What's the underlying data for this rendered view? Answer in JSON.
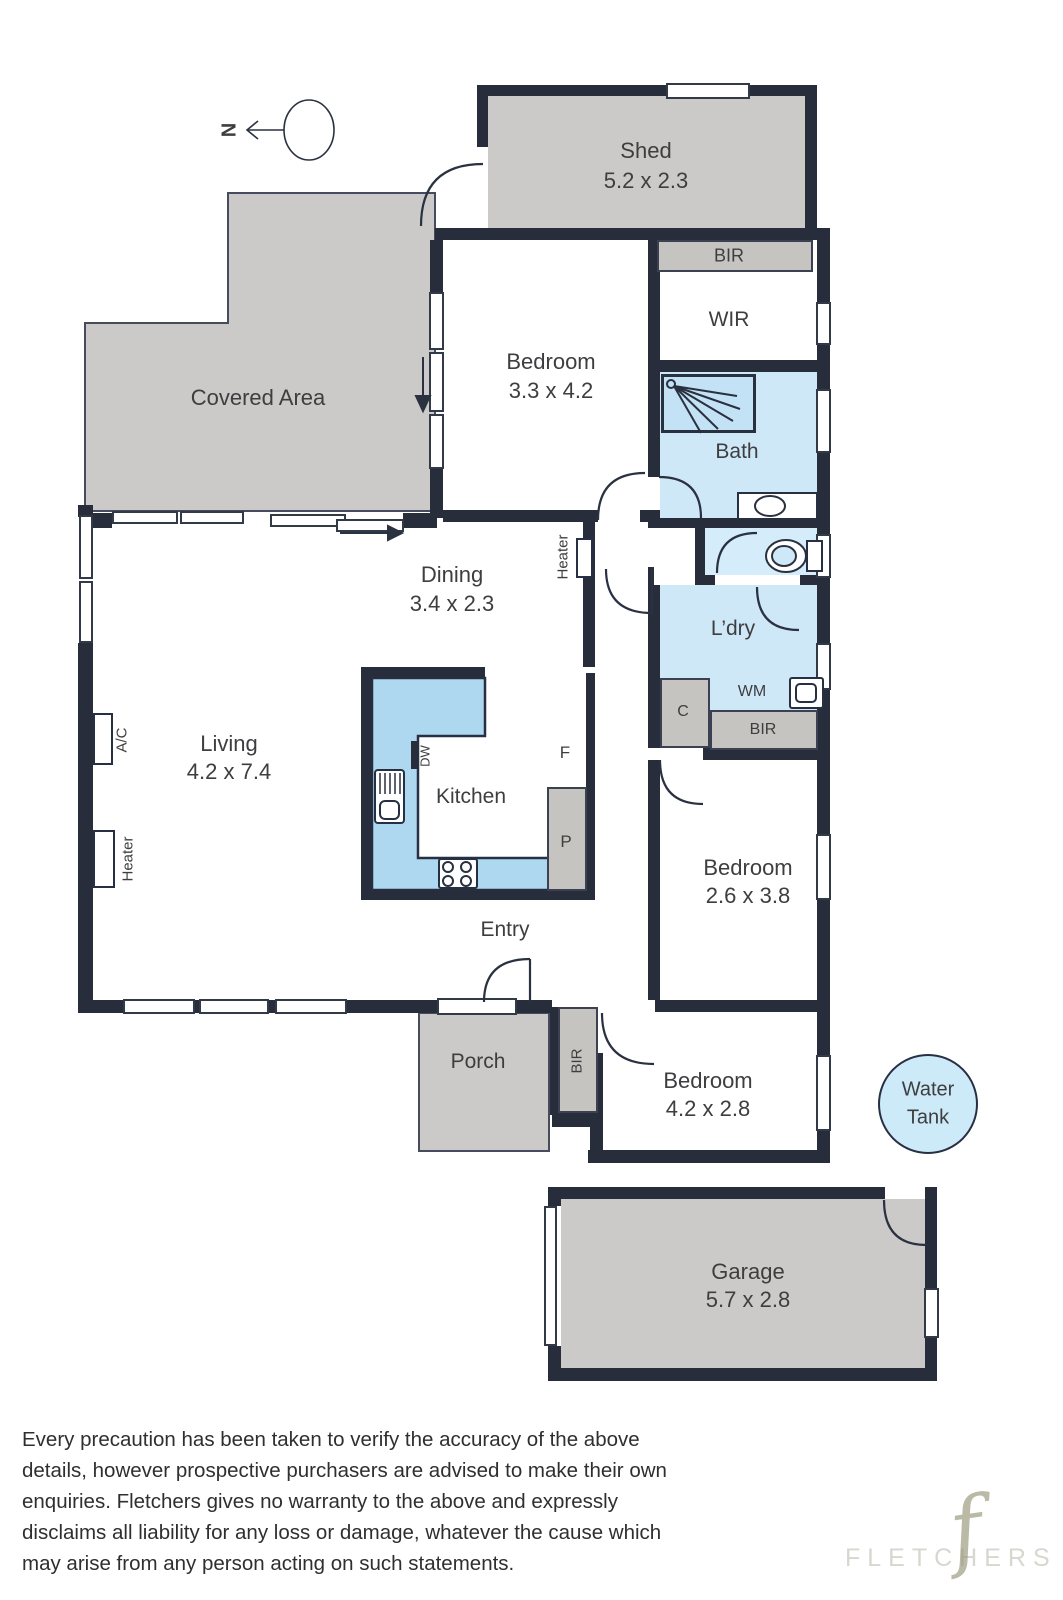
{
  "north_label": "N",
  "rooms": {
    "shed": {
      "name": "Shed",
      "dims": "5.2 x 2.3"
    },
    "covered": {
      "name": "Covered Area"
    },
    "bedroom1": {
      "name": "Bedroom",
      "dims": "3.3 x 4.2"
    },
    "wir": {
      "name": "WIR"
    },
    "bir_top": {
      "name": "BIR"
    },
    "bath": {
      "name": "Bath"
    },
    "dining": {
      "name": "Dining",
      "dims": "3.4 x 2.3"
    },
    "heater_hall": {
      "name": "Heater"
    },
    "ldry": {
      "name": "L’dry"
    },
    "wm": {
      "name": "WM"
    },
    "closet": {
      "name": "C"
    },
    "bir_mid": {
      "name": "BIR"
    },
    "living": {
      "name": "Living",
      "dims": "4.2 x 7.4"
    },
    "ac": {
      "name": "A/C"
    },
    "heater_left": {
      "name": "Heater"
    },
    "kitchen": {
      "name": "Kitchen"
    },
    "dw": {
      "name": "DW"
    },
    "fridge": {
      "name": "F"
    },
    "pantry": {
      "name": "P"
    },
    "entry": {
      "name": "Entry"
    },
    "porch": {
      "name": "Porch"
    },
    "bir_entry": {
      "name": "BIR"
    },
    "bedroom2": {
      "name": "Bedroom",
      "dims": "2.6 x 3.8"
    },
    "bedroom3": {
      "name": "Bedroom",
      "dims": "4.2 x 2.8"
    },
    "water_tank": {
      "line1": "Water",
      "line2": "Tank"
    },
    "garage": {
      "name": "Garage",
      "dims": "5.7 x 2.8"
    }
  },
  "disclaimer": {
    "lines": [
      "Every precaution has been taken to verify the accuracy of the above",
      "details, however prospective purchasers are advised to make their own",
      "enquiries. Fletchers gives no warranty to the above and expressly",
      "disclaims all liability for any loss or damage, whatever the cause which",
      "may arise from any person acting on such statements."
    ]
  },
  "watermark": {
    "brand": "FLETCHERS",
    "glyph": "f"
  },
  "colors": {
    "wall": "#272d3b",
    "outdoor_gray": "#cbcac8",
    "closet_gray": "#c6c4c0",
    "wet_area_blue": "#cfe8f8",
    "kitchen_blue": "#aed8ef",
    "water_tank_blue": "#cdeaf9"
  }
}
